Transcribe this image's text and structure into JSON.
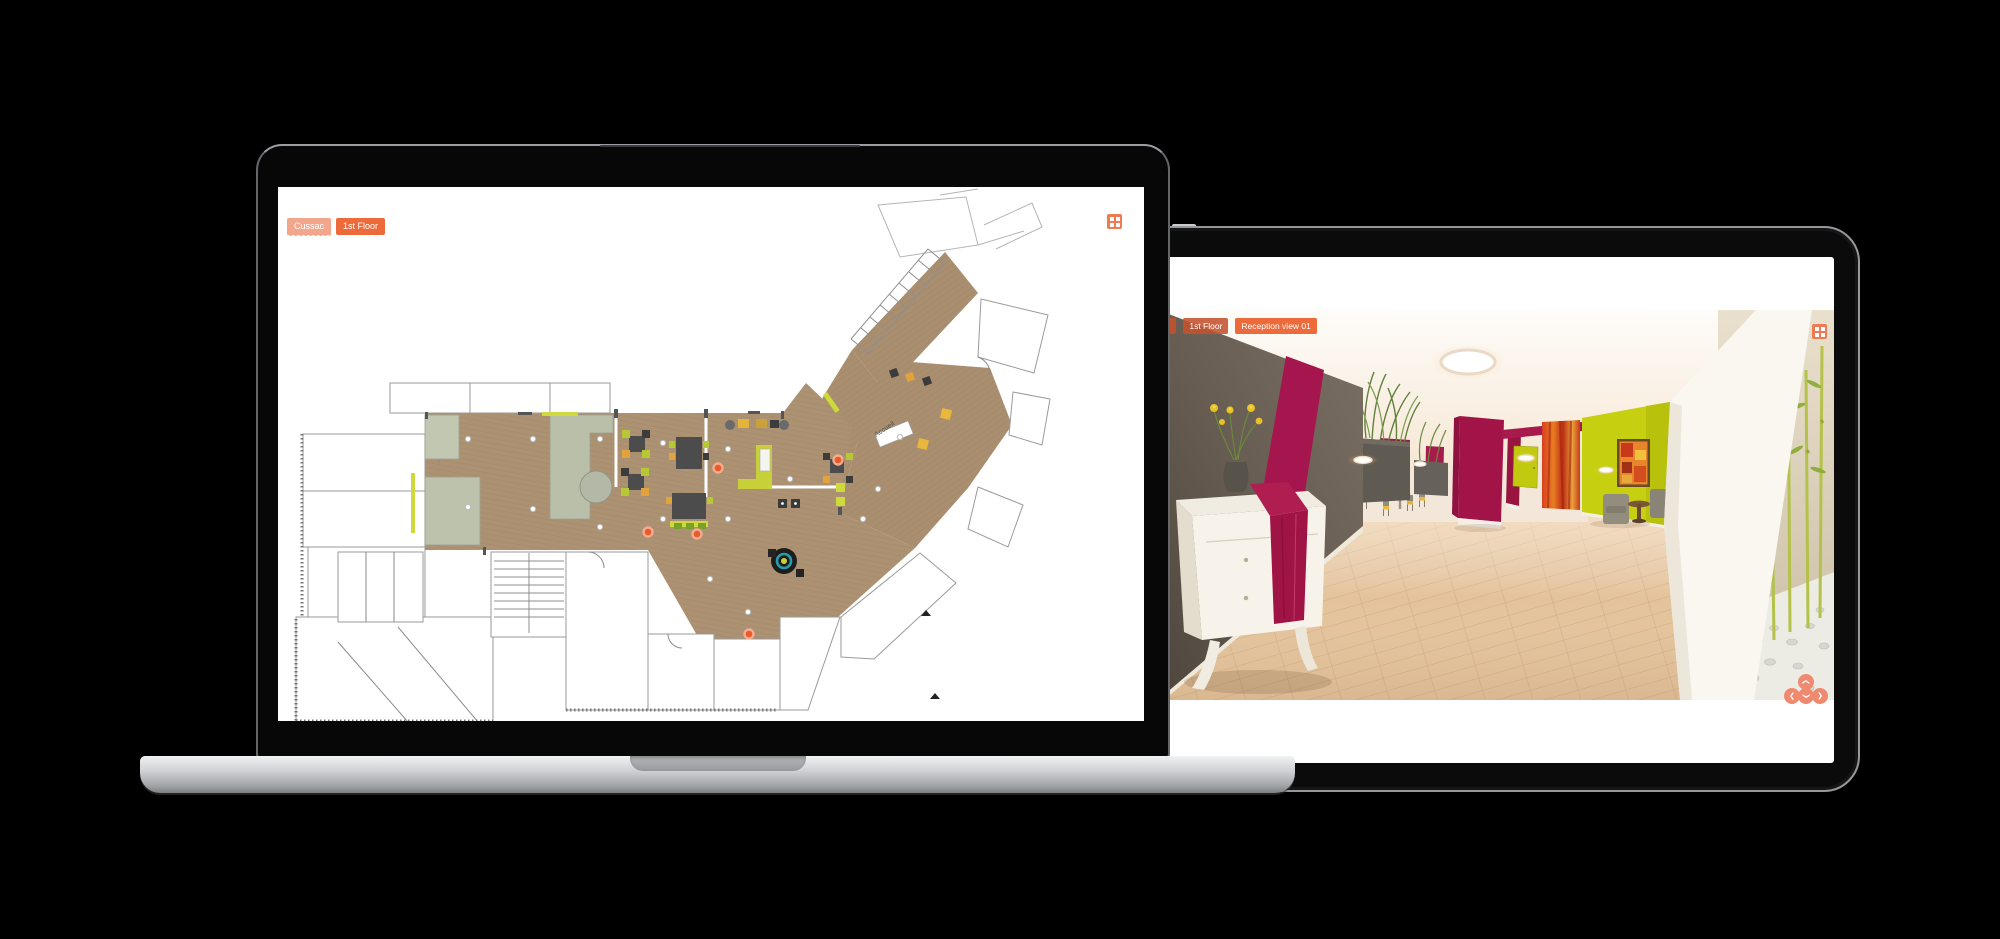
{
  "laptop": {
    "toolbar": {
      "project_button": "Cussac",
      "floor_button": "1st Floor"
    },
    "grid_icon_name": "grid-menu-icon",
    "plan": {
      "accueil_label": "Accueil"
    }
  },
  "tablet": {
    "toolbar": {
      "project_button": "Cussac",
      "floor_button": "1st Floor",
      "view_button": "Reception view 01"
    },
    "grid_icon_name": "grid-menu-icon",
    "dpad": {
      "glyph": "❮",
      "up": "pan-up",
      "left": "pan-left",
      "down": "pan-down",
      "right": "pan-right"
    }
  },
  "colors": {
    "accent_orange": "#ed6a3a",
    "accent_salmon": "#f2a78c",
    "dpad_salmon": "#ef8a70",
    "hotspot_orange": "#ea5a2c",
    "plan_floor_tan": "#ac9272",
    "scene_magenta": "#a21448",
    "scene_chartreuse": "#c6cf10"
  }
}
